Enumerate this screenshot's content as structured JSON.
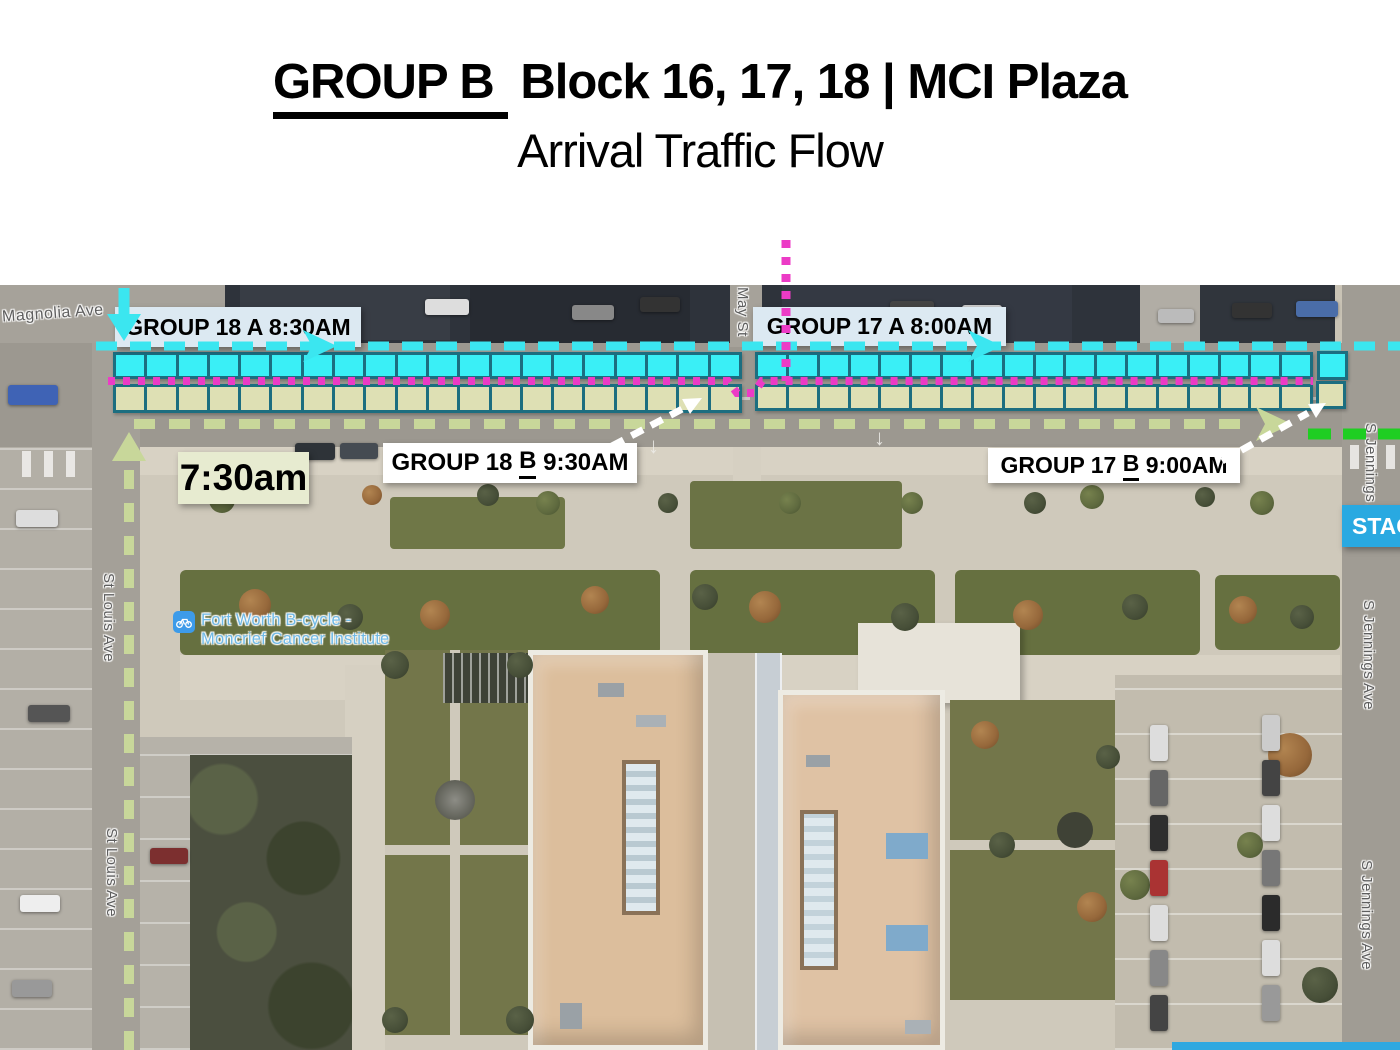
{
  "title": {
    "underlined": "GROUP B",
    "rest": " Block 16, 17, 18 | MCI Plaza",
    "line2": "Arrival Traffic Flow"
  },
  "callouts": {
    "group18a": {
      "label": "GROUP 18 A 8:30AM"
    },
    "group17a": {
      "label": "GROUP 17 A 8:00AM"
    },
    "group18b": {
      "prefix": "GROUP 18 ",
      "underlined": "B",
      "suffix": " 9:30AM"
    },
    "group17b": {
      "prefix": "GROUP 17 ",
      "underlined": "B",
      "suffix": " 9:00AM"
    },
    "arrival_time": {
      "label": "7:30am"
    },
    "staging": {
      "label": "STAGING"
    }
  },
  "map": {
    "streets": {
      "magnolia": "Magnolia Ave",
      "st_louis": "St Louis Ave",
      "may": "May St",
      "jennings": "S Jennings Ave"
    },
    "poi": {
      "line1": "Fort Worth B-cycle -",
      "line2": "Moncrief Cancer Institute",
      "icon": "bicycle-icon"
    }
  },
  "parking": {
    "left_block_spaces": 20,
    "right_block_spaces": 18,
    "offset_spaces": 1,
    "rows": [
      "cyan",
      "beige"
    ]
  },
  "colors": {
    "spot_cyan": "#3AEFF6",
    "spot_beige": "#DEE0B4",
    "spot_border": "#1C6E80",
    "route_cyan": "#3BE6F0",
    "route_magenta": "#EC3BC6",
    "route_pale_green": "#C8D79A",
    "route_bright_green": "#1FCE22",
    "route_white": "#FFFFFF",
    "label_blue_bg": "#DCE9F2",
    "label_white_bg": "#FFFFFF",
    "time_bg": "#E7EBD0",
    "staging_bg": "#29A9E1",
    "staging_text": "#FFFFFF",
    "poi_blue": "#3D9BE9",
    "poi_text": "#6FB9E6"
  }
}
